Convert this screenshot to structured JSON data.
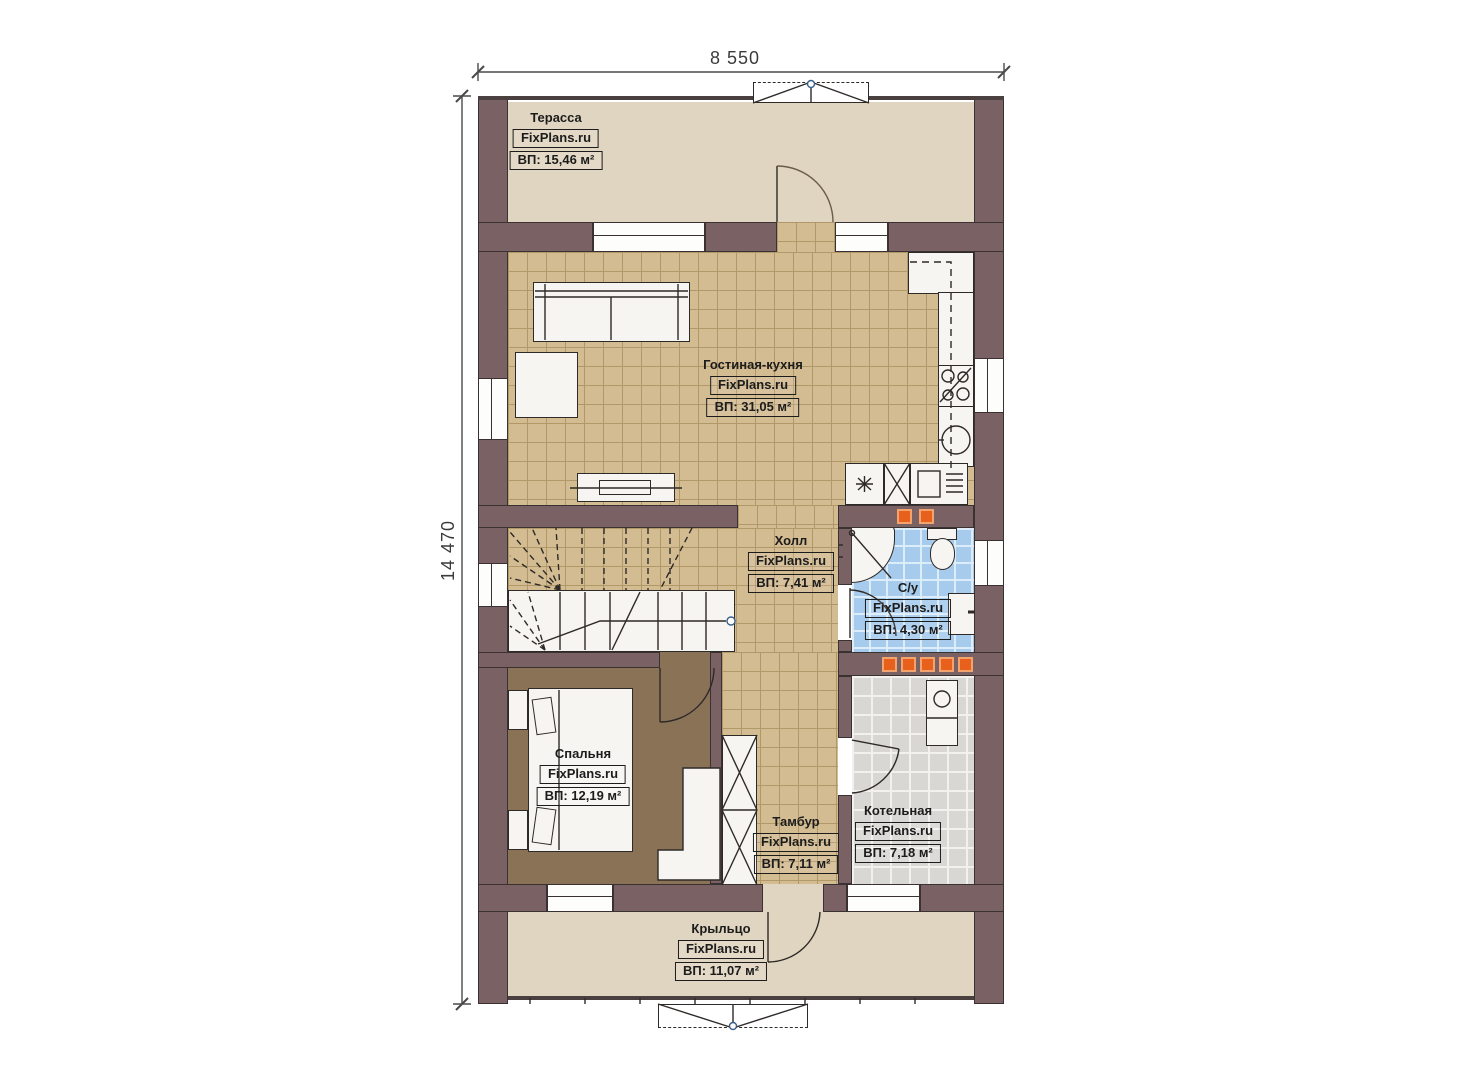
{
  "plan": {
    "type": "floor-plan",
    "brand": "FixPlans.ru",
    "dimensions": {
      "width_label": "8 550",
      "height_label": "14 470"
    },
    "rooms": {
      "terrace": {
        "name": "Терасса",
        "brand": "FixPlans.ru",
        "area": "ВП: 15,46 м²"
      },
      "living_kitchen": {
        "name": "Гостиная-кухня",
        "brand": "FixPlans.ru",
        "area": "ВП: 31,05 м²"
      },
      "hall": {
        "name": "Холл",
        "brand": "FixPlans.ru",
        "area": "ВП: 7,41 м²"
      },
      "bathroom": {
        "name": "С/у",
        "brand": "FixPlans.ru",
        "area": "ВП: 4,30 м²"
      },
      "bedroom": {
        "name": "Спальня",
        "brand": "FixPlans.ru",
        "area": "ВП: 12,19 м²"
      },
      "vestibule": {
        "name": "Тамбур",
        "brand": "FixPlans.ru",
        "area": "ВП: 7,11 м²"
      },
      "boiler_room": {
        "name": "Котельная",
        "brand": "FixPlans.ru",
        "area": "ВП: 7,18 м²"
      },
      "porch": {
        "name": "Крыльцо",
        "brand": "FixPlans.ru",
        "area": "ВП: 11,07 м²"
      }
    },
    "colors": {
      "wall": "#7a6164",
      "floor-light": "#e0d5c0",
      "tile-tan": "#d3bc92",
      "floor-bedroom": "#8a7257",
      "tile-blue": "#a6cbec",
      "tile-gray": "#d8d7d4",
      "accent-orange": "#e8611c"
    }
  }
}
